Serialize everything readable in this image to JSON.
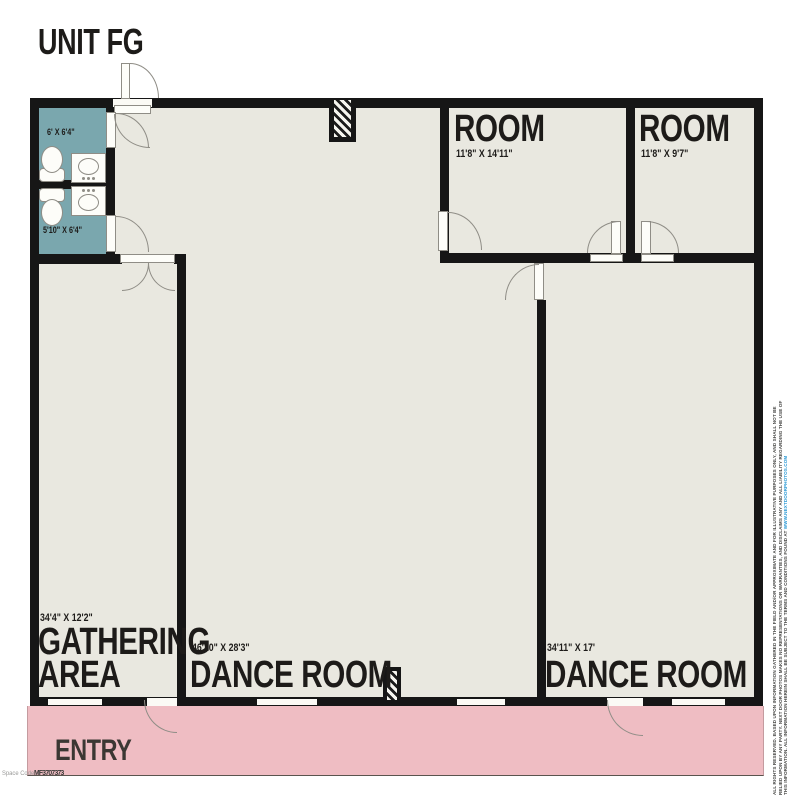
{
  "title": "UNIT FG",
  "plan": {
    "bathroom_top": {
      "dims": "6' X 6'4\""
    },
    "bathroom_bottom": {
      "dims": "5'10\" X 6'4\""
    },
    "room_1": {
      "name": "ROOM",
      "dims": "11'8\" X 14'11\""
    },
    "room_2": {
      "name": "ROOM",
      "dims": "11'8\" X 9'7\""
    },
    "gathering_area": {
      "dims": "34'4\" X 12'2\"",
      "name_line1": "GATHERING",
      "name_line2": "AREA"
    },
    "dance_room_main": {
      "name": "DANCE ROOM",
      "dims": "46'10\" X 28'3\""
    },
    "dance_room_right": {
      "name": "DANCE ROOM",
      "dims": "34'11\" X 17'"
    },
    "entry": {
      "name": "ENTRY"
    }
  },
  "watermark": {
    "label": "Space Code",
    "code": "MF3707373"
  },
  "disclaimer": {
    "line1": "ALL RIGHTS RESERVED. BASED UPON INFORMATION GATHERED IN THE FIELD AND/OR APPROXIMATE AND FOR ILLUSTRATIVE PURPOSES ONLY, AND SHALL NOT BE RELIED UPON BY ANY PARTY. NEXT DOOR PHOTOS MAKES NO REPRESENTATIONS OR WARRANTIES, AND DISCLAIMS ANY AND ALL LIABILITY",
    "line2": "REGARDING THE USE OF THIS INFORMATION. ALL INFORMATION HEREIN SHALL BE SUBJECT TO THE TERMS AND CONDITIONS FOUND AT ",
    "link": "WWW.NEXTDOORPHOTOS.COM"
  },
  "colors": {
    "floor": "#e9e8e0",
    "bathroom": "#7aa7ae",
    "entry": "#efbdc3",
    "wall": "#161616",
    "label": "#1d1b19",
    "link": "#2e9bd6"
  }
}
